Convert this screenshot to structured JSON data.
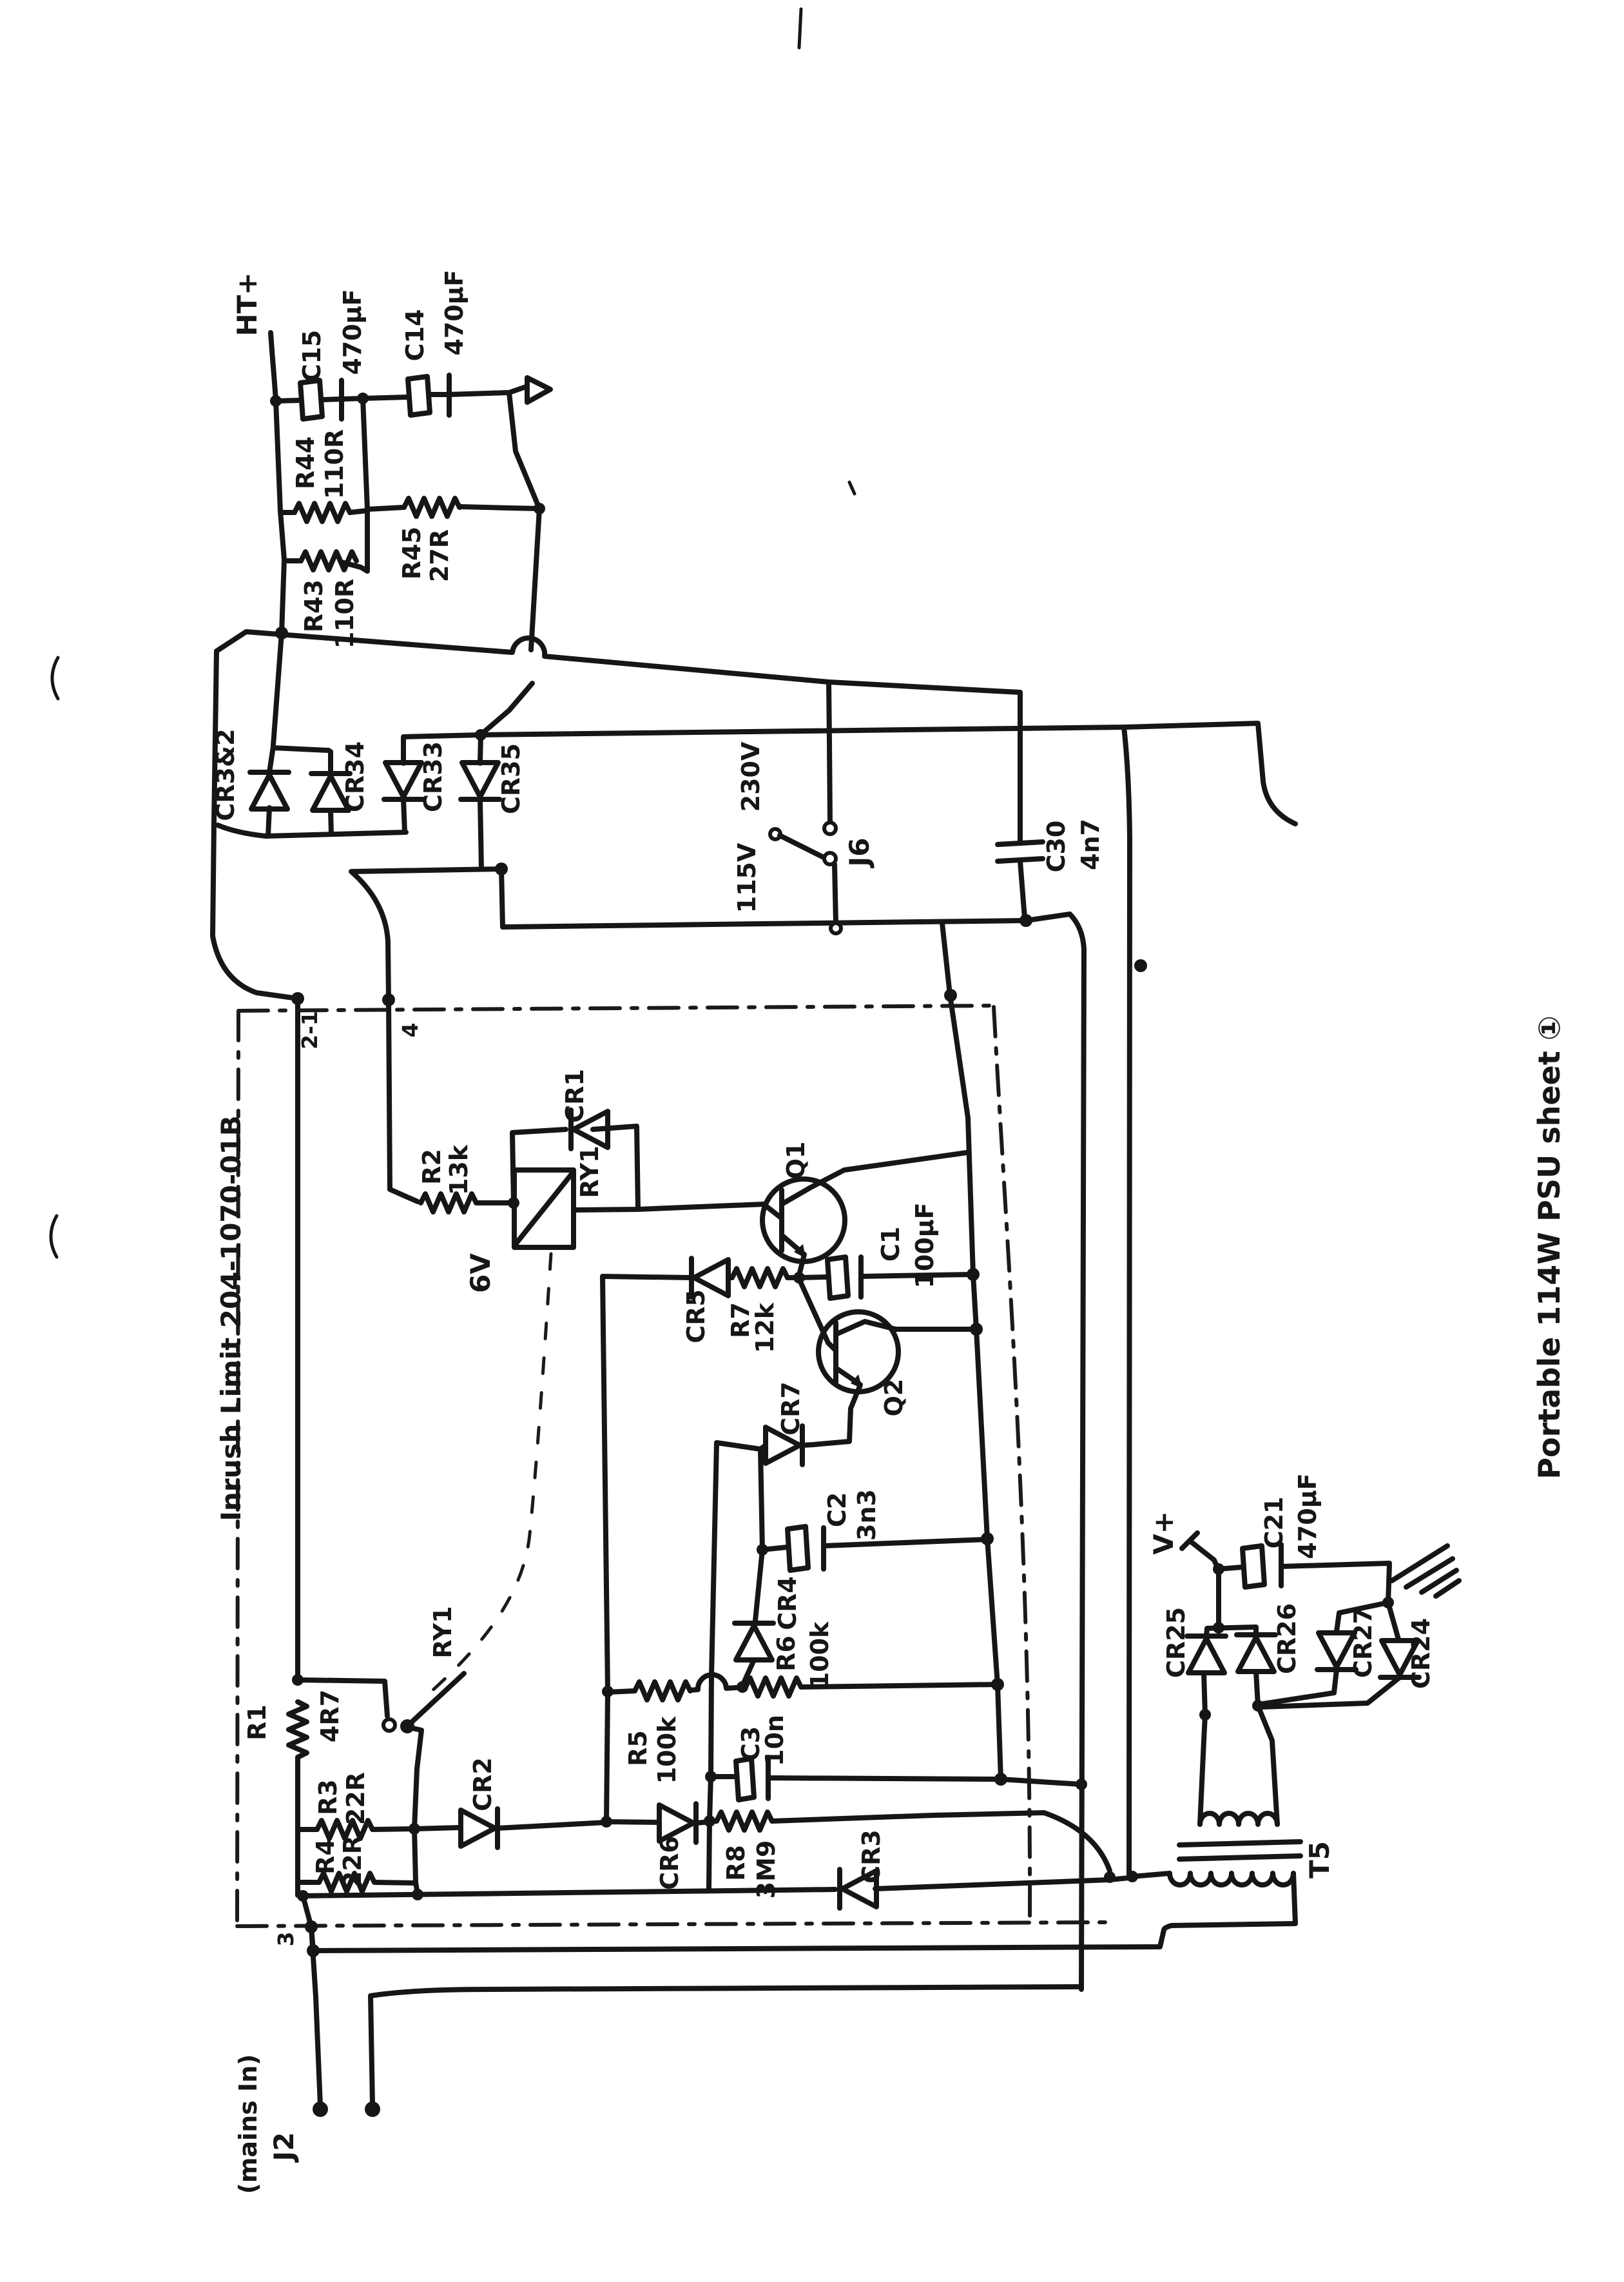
{
  "doc": {
    "title": "Portable 114W PSU sheet ①",
    "kind": "hand-drawn power supply schematic (scanned)"
  },
  "connectors": {
    "mains_input": {
      "ref": "J2",
      "note": "(mains In)"
    },
    "voltage_selector": {
      "ref": "J6",
      "pos_high": "230V",
      "pos_low": "115V"
    },
    "ht_output": "HT+",
    "v_plus": "V+"
  },
  "module": {
    "label": "Inrush Limit 204-1070-01B",
    "pins": {
      "p21": "2-1",
      "p4": "4",
      "p3": "3"
    }
  },
  "components": {
    "c15": {
      "ref": "C15",
      "value": "470µF"
    },
    "c14": {
      "ref": "C14",
      "value": "470µF"
    },
    "r44": {
      "ref": "R44",
      "value": "110R"
    },
    "r45": {
      "ref": "R45",
      "value": "27R"
    },
    "r43": {
      "ref": "R43",
      "value": "110R"
    },
    "cr3x2": {
      "ref": "CR3&2"
    },
    "cr34": {
      "ref": "CR34"
    },
    "cr33": {
      "ref": "CR33"
    },
    "cr35": {
      "ref": "CR35"
    },
    "c30": {
      "ref": "C30",
      "value": "4n7"
    },
    "r2": {
      "ref": "R2",
      "value": "13k"
    },
    "cr1": {
      "ref": "CR1"
    },
    "ry1_coil": {
      "ref": "RY1",
      "value": "6V"
    },
    "q1": {
      "ref": "Q1"
    },
    "cr5": {
      "ref": "CR5"
    },
    "r7": {
      "ref": "R7",
      "value": "12k"
    },
    "c1": {
      "ref": "C1",
      "value": "100µF"
    },
    "q2": {
      "ref": "Q2"
    },
    "cr7": {
      "ref": "CR7"
    },
    "c2": {
      "ref": "C2",
      "value": "3n3"
    },
    "cr4": {
      "ref": "CR4"
    },
    "r6": {
      "ref": "R6",
      "value": "100k"
    },
    "r5": {
      "ref": "R5",
      "value": "100k"
    },
    "c3": {
      "ref": "C3",
      "value": "10n"
    },
    "cr6": {
      "ref": "CR6"
    },
    "r8": {
      "ref": "R8",
      "value": "3M9"
    },
    "cr3": {
      "ref": "CR3"
    },
    "r1": {
      "ref": "R1",
      "value": "4R7"
    },
    "ry1_contact": {
      "ref": "RY1"
    },
    "r3": {
      "ref": "R3",
      "value": "22R"
    },
    "r4": {
      "ref": "R4",
      "value": "22R"
    },
    "cr2": {
      "ref": "CR2"
    },
    "cr25": {
      "ref": "CR25"
    },
    "cr26": {
      "ref": "CR26"
    },
    "cr27": {
      "ref": "CR27"
    },
    "cr24": {
      "ref": "CR24"
    },
    "c21": {
      "ref": "C21",
      "value": "470µF"
    },
    "t5": {
      "ref": "T5"
    }
  }
}
